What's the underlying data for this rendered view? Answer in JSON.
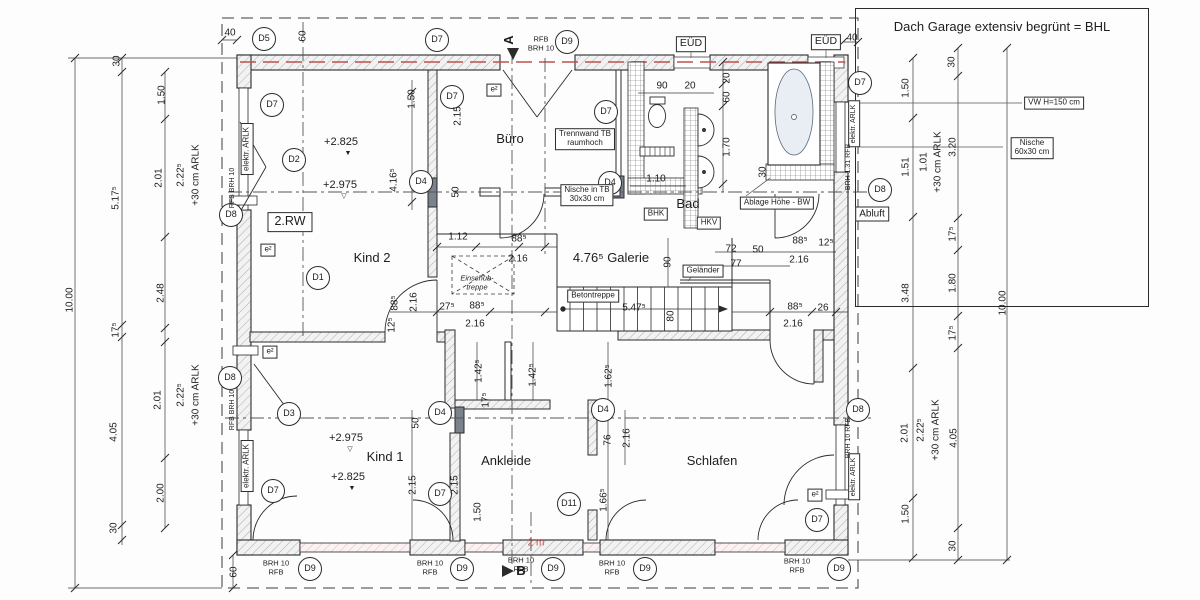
{
  "note_panel": {
    "title": "Dach Garage extensiv begrünt = BHL"
  },
  "plan": {
    "rooms": [
      {
        "n": "room-kind2",
        "t": "Kind 2",
        "x": 372,
        "y": 258,
        "c": "room"
      },
      {
        "n": "room-buero",
        "t": "Büro",
        "x": 510,
        "y": 139,
        "c": "room"
      },
      {
        "n": "room-bad",
        "t": "Bad",
        "x": 688,
        "y": 204,
        "c": "room"
      },
      {
        "n": "room-galerie",
        "t": "4.76⁵ Galerie",
        "x": 611,
        "y": 258,
        "c": "room"
      },
      {
        "n": "room-kind1",
        "t": "Kind 1",
        "x": 385,
        "y": 457,
        "c": "room"
      },
      {
        "n": "room-ankleide",
        "t": "Ankleide",
        "x": 506,
        "y": 461,
        "c": "room"
      },
      {
        "n": "room-schlafen",
        "t": "Schlafen",
        "x": 712,
        "y": 461,
        "c": "room"
      }
    ],
    "levels": [
      {
        "n": "level-mark",
        "t": "+2.825",
        "x": 341,
        "y": 142,
        "c": "level"
      },
      {
        "n": "level-triangle-filled",
        "t": "▼",
        "x": 348,
        "y": 154,
        "c": "tri"
      },
      {
        "n": "level-mark",
        "t": "+2.975",
        "x": 340,
        "y": 185,
        "c": "level"
      },
      {
        "n": "level-triangle-hollow",
        "t": "▽",
        "x": 344,
        "y": 197,
        "c": "tri"
      },
      {
        "n": "level-mark",
        "t": "+2.975",
        "x": 346,
        "y": 438,
        "c": "level"
      },
      {
        "n": "level-triangle-hollow",
        "t": "▽",
        "x": 350,
        "y": 450,
        "c": "tri"
      },
      {
        "n": "level-mark",
        "t": "+2.825",
        "x": 348,
        "y": 477,
        "c": "level"
      },
      {
        "n": "level-triangle-filled",
        "t": "▼",
        "x": 352,
        "y": 489,
        "c": "tri"
      }
    ],
    "markers": [
      {
        "n": "marker-d5",
        "t": "D5",
        "x": 264,
        "y": 39,
        "c": "circ"
      },
      {
        "n": "marker-d7",
        "t": "D7",
        "x": 437,
        "y": 40,
        "c": "circ"
      },
      {
        "n": "marker-d9",
        "t": "D9",
        "x": 567,
        "y": 42,
        "c": "circ"
      },
      {
        "n": "marker-d7",
        "t": "D7",
        "x": 860,
        "y": 83,
        "c": "circ"
      },
      {
        "n": "marker-d8",
        "t": "D8",
        "x": 880,
        "y": 190,
        "c": "circ"
      },
      {
        "n": "marker-d8",
        "t": "D8",
        "x": 231,
        "y": 215,
        "c": "circ"
      },
      {
        "n": "marker-d8",
        "t": "D8",
        "x": 230,
        "y": 378,
        "c": "circ"
      },
      {
        "n": "marker-d7",
        "t": "D7",
        "x": 273,
        "y": 491,
        "c": "circ"
      },
      {
        "n": "marker-d9",
        "t": "D9",
        "x": 310,
        "y": 569,
        "c": "circ"
      },
      {
        "n": "marker-d9",
        "t": "D9",
        "x": 462,
        "y": 569,
        "c": "circ"
      },
      {
        "n": "marker-d9",
        "t": "D9",
        "x": 553,
        "y": 569,
        "c": "circ"
      },
      {
        "n": "marker-d9",
        "t": "D9",
        "x": 645,
        "y": 569,
        "c": "circ"
      },
      {
        "n": "marker-d9",
        "t": "D9",
        "x": 839,
        "y": 569,
        "c": "circ"
      },
      {
        "n": "marker-d8",
        "t": "D8",
        "x": 858,
        "y": 410,
        "c": "circ"
      },
      {
        "n": "marker-d7",
        "t": "D7",
        "x": 817,
        "y": 520,
        "c": "circ"
      },
      {
        "n": "marker-d7",
        "t": "D7",
        "x": 272,
        "y": 105,
        "c": "circ"
      },
      {
        "n": "marker-d2",
        "t": "D2",
        "x": 294,
        "y": 160,
        "c": "circ"
      },
      {
        "n": "marker-d1",
        "t": "D1",
        "x": 318,
        "y": 278,
        "c": "circ"
      },
      {
        "n": "marker-d4",
        "t": "D4",
        "x": 421,
        "y": 182,
        "c": "circ"
      },
      {
        "n": "marker-d7",
        "t": "D7",
        "x": 452,
        "y": 97,
        "c": "circ"
      },
      {
        "n": "marker-d7",
        "t": "D7",
        "x": 606,
        "y": 112,
        "c": "circ"
      },
      {
        "n": "marker-d4",
        "t": "D4",
        "x": 610,
        "y": 183,
        "c": "circ"
      },
      {
        "n": "marker-d4",
        "t": "D4",
        "x": 440,
        "y": 413,
        "c": "circ"
      },
      {
        "n": "marker-d4",
        "t": "D4",
        "x": 603,
        "y": 410,
        "c": "circ"
      },
      {
        "n": "marker-d11",
        "t": "D11",
        "x": 569,
        "y": 504,
        "c": "circ"
      },
      {
        "n": "marker-d7",
        "t": "D7",
        "x": 440,
        "y": 494,
        "c": "circ"
      },
      {
        "n": "marker-d3",
        "t": "D3",
        "x": 289,
        "y": 414,
        "c": "circ"
      }
    ],
    "boxes": [
      {
        "n": "label-2rw",
        "t": "2.RW",
        "x": 290,
        "y": 222,
        "c": "boxed rw"
      },
      {
        "n": "label-eud",
        "t": "EÜD",
        "x": 691,
        "y": 44,
        "c": "boxed big"
      },
      {
        "n": "label-eud",
        "t": "EÜD",
        "x": 826,
        "y": 42,
        "c": "boxed big"
      },
      {
        "n": "label-trennwand",
        "t": "Trennwand TB\nraumhoch",
        "x": 585,
        "y": 139,
        "c": "boxed small"
      },
      {
        "n": "label-nische-tb",
        "t": "Nische in TB\n30x30 cm",
        "x": 587,
        "y": 195,
        "c": "boxed small"
      },
      {
        "n": "label-bhk",
        "t": "BHK",
        "x": 656,
        "y": 214,
        "c": "boxed small"
      },
      {
        "n": "label-hkv",
        "t": "HKV",
        "x": 709,
        "y": 223,
        "c": "boxed small"
      },
      {
        "n": "label-ablage",
        "t": "Ablage Höhe - BW",
        "x": 777,
        "y": 203,
        "c": "boxed small"
      },
      {
        "n": "label-gelaender",
        "t": "Geländer",
        "x": 703,
        "y": 271,
        "c": "boxed small"
      },
      {
        "n": "label-betontreppe",
        "t": "Betontreppe",
        "x": 593,
        "y": 296,
        "c": "boxed small"
      },
      {
        "n": "label-abluft",
        "t": "Abluft",
        "x": 872,
        "y": 214,
        "c": "boxed"
      },
      {
        "n": "label-vw",
        "t": "VW H=150 cm",
        "x": 1054,
        "y": 103,
        "c": "boxed small"
      },
      {
        "n": "label-nische-60",
        "t": "Nische\n60x30 cm",
        "x": 1032,
        "y": 148,
        "c": "boxed small"
      },
      {
        "n": "label-elektr-arlk",
        "t": "elektr. ARLK",
        "x": 247,
        "y": 149,
        "c": "boxed small rot"
      },
      {
        "n": "label-elektr-arlk",
        "t": "elektr. ARLK",
        "x": 247,
        "y": 466,
        "c": "boxed small rot"
      },
      {
        "n": "label-elektr-arlk",
        "t": "elektr. ARLK",
        "x": 854,
        "y": 124,
        "c": "boxed tiny rot"
      },
      {
        "n": "label-elektr-arlk",
        "t": "elektr. ARLK",
        "x": 854,
        "y": 477,
        "c": "boxed tiny rot"
      },
      {
        "n": "label-e2",
        "t": "e²",
        "x": 494,
        "y": 90,
        "c": "boxed small"
      },
      {
        "n": "label-e2",
        "t": "e²",
        "x": 268,
        "y": 250,
        "c": "boxed small"
      },
      {
        "n": "label-e2",
        "t": "e²",
        "x": 270,
        "y": 352,
        "c": "boxed small"
      },
      {
        "n": "label-e2",
        "t": "e²",
        "x": 815,
        "y": 495,
        "c": "boxed small"
      }
    ],
    "dims": [
      {
        "n": "dim",
        "t": "10.00",
        "x": 70,
        "y": 300,
        "c": "dim rot"
      },
      {
        "n": "dim",
        "t": "30",
        "x": 117,
        "y": 61,
        "c": "dim rot"
      },
      {
        "n": "dim",
        "t": "5.17⁵",
        "x": 116,
        "y": 198,
        "c": "dim rot"
      },
      {
        "n": "dim",
        "t": "17⁵",
        "x": 116,
        "y": 330,
        "c": "dim rot"
      },
      {
        "n": "dim",
        "t": "4.05",
        "x": 114,
        "y": 432,
        "c": "dim rot"
      },
      {
        "n": "dim",
        "t": "30",
        "x": 114,
        "y": 528,
        "c": "dim rot"
      },
      {
        "n": "dim",
        "t": "1.50",
        "x": 162,
        "y": 95,
        "c": "dim rot"
      },
      {
        "n": "dim",
        "t": "2.01",
        "x": 159,
        "y": 178,
        "c": "dim rot"
      },
      {
        "n": "dim",
        "t": "2.48",
        "x": 161,
        "y": 293,
        "c": "dim rot"
      },
      {
        "n": "dim",
        "t": "2.01",
        "x": 158,
        "y": 400,
        "c": "dim rot"
      },
      {
        "n": "dim",
        "t": "2.00",
        "x": 161,
        "y": 493,
        "c": "dim rot"
      },
      {
        "n": "dim",
        "t": "2.22⁵",
        "x": 181,
        "y": 175,
        "c": "dim rot"
      },
      {
        "n": "dim",
        "t": "+30 cm ARLK",
        "x": 196,
        "y": 175,
        "c": "dim rot"
      },
      {
        "n": "dim",
        "t": "2.22⁵",
        "x": 181,
        "y": 395,
        "c": "dim rot"
      },
      {
        "n": "dim",
        "t": "+30 cm ARLK",
        "x": 196,
        "y": 395,
        "c": "dim rot"
      },
      {
        "n": "dim",
        "t": "40",
        "x": 230,
        "y": 33,
        "c": "dim"
      },
      {
        "n": "dim",
        "t": "60",
        "x": 303,
        "y": 36,
        "c": "dim rot"
      },
      {
        "n": "dim",
        "t": "40",
        "x": 852,
        "y": 38,
        "c": "dim"
      },
      {
        "n": "dim",
        "t": "60",
        "x": 234,
        "y": 572,
        "c": "dim rot"
      },
      {
        "n": "dim",
        "t": "1.50",
        "x": 906,
        "y": 88,
        "c": "dim rot"
      },
      {
        "n": "dim",
        "t": "1.01",
        "x": 924,
        "y": 162,
        "c": "dim rot"
      },
      {
        "n": "dim",
        "t": "+30 cm ARLK",
        "x": 938,
        "y": 162,
        "c": "dim rot"
      },
      {
        "n": "dim",
        "t": "1.51",
        "x": 906,
        "y": 167,
        "c": "dim rot"
      },
      {
        "n": "dim",
        "t": "3.48",
        "x": 906,
        "y": 293,
        "c": "dim rot"
      },
      {
        "n": "dim",
        "t": "2.01",
        "x": 905,
        "y": 433,
        "c": "dim rot"
      },
      {
        "n": "dim",
        "t": "2.22⁵",
        "x": 921,
        "y": 430,
        "c": "dim rot"
      },
      {
        "n": "dim",
        "t": "+30 cm ARLK",
        "x": 936,
        "y": 430,
        "c": "dim rot"
      },
      {
        "n": "dim",
        "t": "1.50",
        "x": 906,
        "y": 514,
        "c": "dim rot"
      },
      {
        "n": "dim",
        "t": "30",
        "x": 952,
        "y": 62,
        "c": "dim rot"
      },
      {
        "n": "dim",
        "t": "3.20",
        "x": 953,
        "y": 147,
        "c": "dim rot"
      },
      {
        "n": "dim",
        "t": "17⁵",
        "x": 953,
        "y": 234,
        "c": "dim rot"
      },
      {
        "n": "dim",
        "t": "1.80",
        "x": 953,
        "y": 283,
        "c": "dim rot"
      },
      {
        "n": "dim",
        "t": "17⁵",
        "x": 953,
        "y": 333,
        "c": "dim rot"
      },
      {
        "n": "dim",
        "t": "4.05",
        "x": 954,
        "y": 438,
        "c": "dim rot"
      },
      {
        "n": "dim",
        "t": "30",
        "x": 953,
        "y": 546,
        "c": "dim rot"
      },
      {
        "n": "dim",
        "t": "10.00",
        "x": 1003,
        "y": 303,
        "c": "dim rot"
      },
      {
        "n": "dim",
        "t": "1.50",
        "x": 412,
        "y": 99,
        "c": "dim rot"
      },
      {
        "n": "dim",
        "t": "2.15",
        "x": 458,
        "y": 116,
        "c": "dim rot"
      },
      {
        "n": "dim",
        "t": "4.16⁵",
        "x": 394,
        "y": 180,
        "c": "dim rot"
      },
      {
        "n": "dim",
        "t": "50",
        "x": 456,
        "y": 192,
        "c": "dim rot"
      },
      {
        "n": "dim",
        "t": "90",
        "x": 662,
        "y": 86,
        "c": "dim"
      },
      {
        "n": "dim",
        "t": "20",
        "x": 690,
        "y": 86,
        "c": "dim"
      },
      {
        "n": "dim",
        "t": "20",
        "x": 727,
        "y": 78,
        "c": "dim rot"
      },
      {
        "n": "dim",
        "t": "60",
        "x": 727,
        "y": 97,
        "c": "dim rot"
      },
      {
        "n": "dim",
        "t": "1.70",
        "x": 727,
        "y": 147,
        "c": "dim rot"
      },
      {
        "n": "dim",
        "t": "1.10",
        "x": 656,
        "y": 179,
        "c": "dim"
      },
      {
        "n": "dim",
        "t": "30",
        "x": 763,
        "y": 172,
        "c": "dim rot"
      },
      {
        "n": "dim",
        "t": "1.12",
        "x": 458,
        "y": 237,
        "c": "dim"
      },
      {
        "n": "dim",
        "t": "88⁵",
        "x": 519,
        "y": 239,
        "c": "dim"
      },
      {
        "n": "dim",
        "t": "2.16",
        "x": 518,
        "y": 259,
        "c": "dim"
      },
      {
        "n": "dim",
        "t": "90",
        "x": 668,
        "y": 262,
        "c": "dim rot"
      },
      {
        "n": "dim",
        "t": "72",
        "x": 731,
        "y": 249,
        "c": "dim"
      },
      {
        "n": "dim",
        "t": "50",
        "x": 758,
        "y": 250,
        "c": "dim"
      },
      {
        "n": "dim",
        "t": "77",
        "x": 736,
        "y": 264,
        "c": "dim"
      },
      {
        "n": "dim",
        "t": "88⁵",
        "x": 800,
        "y": 241,
        "c": "dim"
      },
      {
        "n": "dim",
        "t": "12⁵",
        "x": 826,
        "y": 243,
        "c": "dim"
      },
      {
        "n": "dim",
        "t": "2.16",
        "x": 799,
        "y": 260,
        "c": "dim"
      },
      {
        "n": "dim",
        "t": "5.47⁵",
        "x": 634,
        "y": 308,
        "c": "dim"
      },
      {
        "n": "dim",
        "t": "80",
        "x": 671,
        "y": 316,
        "c": "dim rot"
      },
      {
        "n": "dim",
        "t": "27⁵",
        "x": 447,
        "y": 307,
        "c": "dim"
      },
      {
        "n": "dim",
        "t": "88⁵",
        "x": 477,
        "y": 306,
        "c": "dim"
      },
      {
        "n": "dim",
        "t": "2.16",
        "x": 475,
        "y": 324,
        "c": "dim"
      },
      {
        "n": "dim",
        "t": "88⁵",
        "x": 395,
        "y": 303,
        "c": "dim rot"
      },
      {
        "n": "dim",
        "t": "2.16",
        "x": 414,
        "y": 302,
        "c": "dim rot"
      },
      {
        "n": "dim",
        "t": "12⁵",
        "x": 392,
        "y": 325,
        "c": "dim rot"
      },
      {
        "n": "dim",
        "t": "88⁵",
        "x": 795,
        "y": 307,
        "c": "dim"
      },
      {
        "n": "dim",
        "t": "26",
        "x": 823,
        "y": 308,
        "c": "dim"
      },
      {
        "n": "dim",
        "t": "2.16",
        "x": 793,
        "y": 324,
        "c": "dim"
      },
      {
        "n": "dim",
        "t": "1.42⁵",
        "x": 479,
        "y": 371,
        "c": "dim rot"
      },
      {
        "n": "dim",
        "t": "1.42⁵",
        "x": 533,
        "y": 375,
        "c": "dim rot"
      },
      {
        "n": "dim",
        "t": "17⁵",
        "x": 486,
        "y": 400,
        "c": "dim rot"
      },
      {
        "n": "dim",
        "t": "50",
        "x": 416,
        "y": 423,
        "c": "dim rot"
      },
      {
        "n": "dim",
        "t": "1.62⁵",
        "x": 609,
        "y": 376,
        "c": "dim rot"
      },
      {
        "n": "dim",
        "t": "2.16",
        "x": 627,
        "y": 438,
        "c": "dim rot"
      },
      {
        "n": "dim",
        "t": "76",
        "x": 608,
        "y": 440,
        "c": "dim rot"
      },
      {
        "n": "dim",
        "t": "1.66⁵",
        "x": 604,
        "y": 500,
        "c": "dim rot"
      },
      {
        "n": "dim",
        "t": "1.50",
        "x": 478,
        "y": 512,
        "c": "dim rot"
      },
      {
        "n": "dim",
        "t": "2.15",
        "x": 413,
        "y": 485,
        "c": "dim rot"
      },
      {
        "n": "dim",
        "t": "2.15",
        "x": 455,
        "y": 485,
        "c": "dim rot"
      }
    ],
    "texts": [
      {
        "n": "section-marker-a",
        "t": "A",
        "x": 509,
        "y": 40,
        "c": "section rot"
      },
      {
        "n": "label-rfb-brh",
        "t": "RFB\nBRH 10",
        "x": 541,
        "y": 44,
        "c": "tiny2"
      },
      {
        "n": "section-marker-b",
        "t": "B",
        "x": 521,
        "y": 571,
        "c": "section"
      },
      {
        "n": "note-2m",
        "t": "2 m",
        "x": 536,
        "y": 543,
        "c": "red"
      },
      {
        "n": "label-rfb-brh",
        "t": "RFB  BRH 10",
        "x": 233,
        "y": 188,
        "c": "tiny rot"
      },
      {
        "n": "label-rfb-brh",
        "t": "RFB  BRH 10",
        "x": 233,
        "y": 410,
        "c": "tiny rot"
      },
      {
        "n": "label-brh-131",
        "t": "BRH 1.31  RFB",
        "x": 849,
        "y": 167,
        "c": "tiny rot"
      },
      {
        "n": "label-brh-10",
        "t": "BRH 10  RFB",
        "x": 849,
        "y": 438,
        "c": "tiny rot"
      },
      {
        "n": "label-brh-rfb",
        "t": "BRH 10\nRFB",
        "x": 276,
        "y": 568,
        "c": "tiny2"
      },
      {
        "n": "label-brh-rfb",
        "t": "BRH 10\nRFB",
        "x": 430,
        "y": 568,
        "c": "tiny2"
      },
      {
        "n": "label-brh-rfb",
        "t": "BRH 10\nRFB",
        "x": 521,
        "y": 565,
        "c": "tiny2"
      },
      {
        "n": "label-brh-rfb",
        "t": "BRH 10\nRFB",
        "x": 612,
        "y": 568,
        "c": "tiny2"
      },
      {
        "n": "label-brh-rfb",
        "t": "BRH 10\nRFB",
        "x": 797,
        "y": 566,
        "c": "tiny2"
      },
      {
        "n": "label-einschubtreppe",
        "t": "Einschub-\ntreppe",
        "x": 477,
        "y": 283,
        "c": "tiny2 italic"
      }
    ]
  }
}
